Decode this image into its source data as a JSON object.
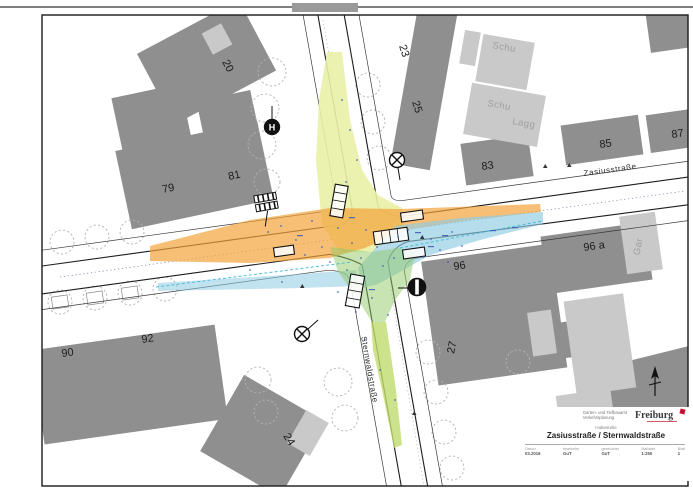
{
  "map": {
    "streets": {
      "zasius": "Zasiusstraße",
      "sternwald": "Sternwaldstraße"
    },
    "building_labels": {
      "b20": "20",
      "b23": "23",
      "b25": "25",
      "b79": "79",
      "b81": "81",
      "b83": "83",
      "b85": "85",
      "b87": "87",
      "b90": "90",
      "b92": "92",
      "b96": "96",
      "b96a": "96 a",
      "b27": "27",
      "b24": "24"
    },
    "annex_labels": {
      "schu1": "Schu",
      "schu2": "Schu",
      "lagg": "Lagg",
      "gar": "Gar"
    },
    "symbols": {
      "bus_stop": "H"
    }
  },
  "title_block": {
    "department_line1": "Garten- und Tiefbauamt",
    "department_line2": "Verkehrsplanung",
    "logo_text": "Freiburg",
    "subtitle": "Haltestelle",
    "title": "Zasiusstraße / Sternwaldstraße",
    "fields": [
      {
        "label": "Datum",
        "value": "03.2016"
      },
      {
        "label": "bearbeitet",
        "value": "GuT"
      },
      {
        "label": "gezeichnet",
        "value": "GuT"
      },
      {
        "label": "Maßstab",
        "value": "1:250"
      },
      {
        "label": "Blatt",
        "value": "1"
      }
    ]
  },
  "colors": {
    "building_dark": "#8f8f8f",
    "building_light": "#c9c9c9",
    "zone_orange": "#f3a43a",
    "zone_yellow": "#e9f0a6",
    "zone_blue": "#8ecbe2",
    "zone_green": "#93c968",
    "zone_green_strip": "#c0dc6e",
    "accent_red": "#c1122f",
    "annotation_blue": "#3a56b4"
  }
}
